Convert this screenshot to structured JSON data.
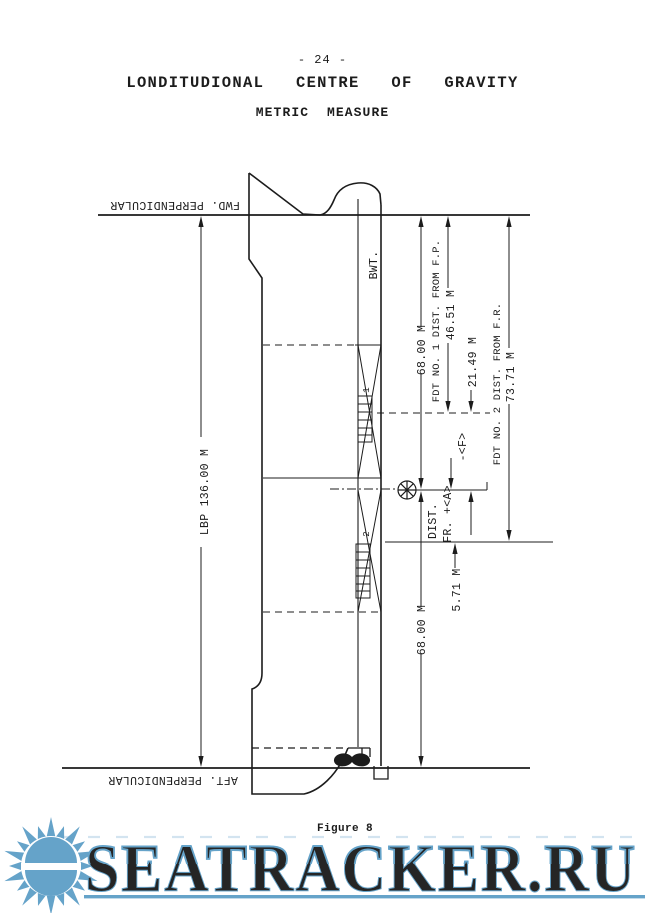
{
  "page": {
    "number": "- 24 -",
    "title": "LONDITUDIONAL   CENTRE   OF   GRAVITY",
    "subtitle": "METRIC  MEASURE",
    "figure_caption": "Figure 8"
  },
  "diagram": {
    "fwd_perpendicular": "FWD. PERPENDICULAR",
    "aft_perpendicular": "AFT. PERPENDICULAR",
    "lbp": "LBP  136.00 M",
    "bwt": "BWT.",
    "dist_fp_68": "68.00 M",
    "fdt1_label": "FDT NO. 1  DIST. FROM F.P.",
    "fdt1_dist": "46.51 M",
    "mid_dist": "21.49 M",
    "fwd_sign": "-<F>",
    "dist_label_line1": "DIST.",
    "dist_label_line2": "FR. +<A>",
    "aft_dist": "5.71 M",
    "fdt2_label": "FDT NO. 2  DIST. FROM F.R.",
    "fdt2_dist": "73.71 M",
    "ap_dist_68": "68.00 M",
    "tank1_no": "1",
    "tank2_no": "2"
  },
  "watermark": {
    "text": "SEATRACKER.RU",
    "color": "#5f9fc7"
  },
  "colors": {
    "ink": "#1c1c1c",
    "paper": "#ffffff"
  }
}
